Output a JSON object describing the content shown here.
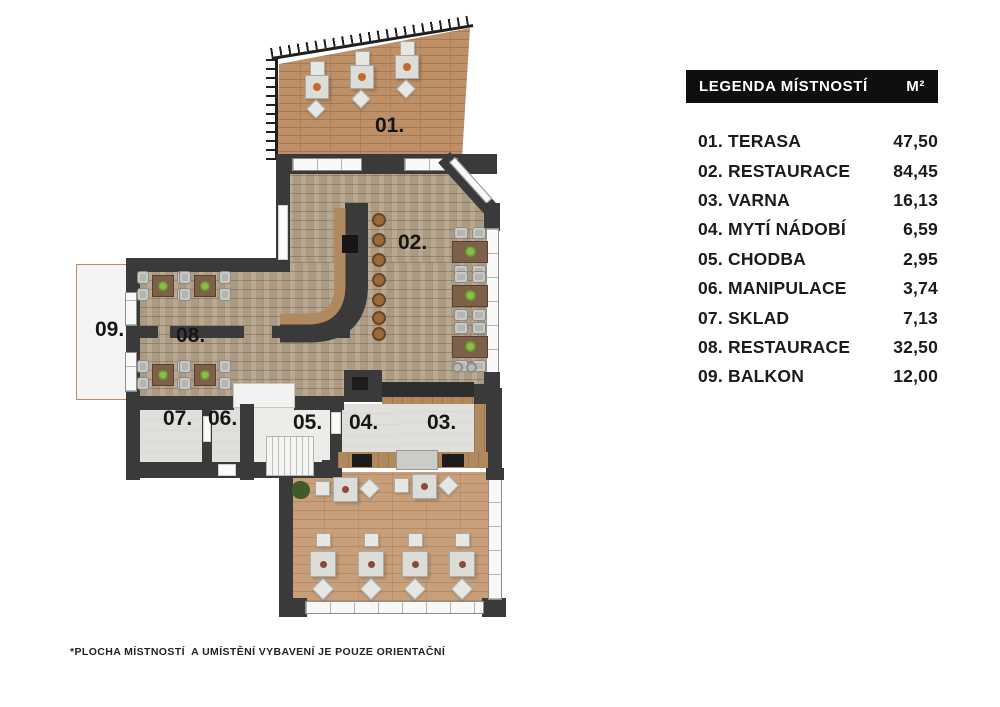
{
  "legend": {
    "title": "LEGENDA MÍSTNOSTÍ",
    "unit": "M²",
    "rows": [
      {
        "name": "01. TERASA",
        "area": "47,50"
      },
      {
        "name": "02. RESTAURACE",
        "area": "84,45"
      },
      {
        "name": "03. VARNA",
        "area": "16,13"
      },
      {
        "name": "04. MYTÍ NÁDOBÍ",
        "area": "6,59"
      },
      {
        "name": "05. CHODBA",
        "area": "2,95"
      },
      {
        "name": "06. MANIPULACE",
        "area": "3,74"
      },
      {
        "name": "07. SKLAD",
        "area": "7,13"
      },
      {
        "name": "08. RESTAURACE",
        "area": "32,50"
      },
      {
        "name": "09. BALKON",
        "area": "12,00"
      }
    ]
  },
  "plan": {
    "labels": {
      "r1": "01.",
      "r2": "02.",
      "r3": "03.",
      "r4": "04.",
      "r5": "05.",
      "r6": "06.",
      "r7": "07.",
      "r8": "08.",
      "r9": "09."
    }
  },
  "footnote": "*PLOCHA MÍSTNOSTÍ  A UMÍSTĚNÍ VYBAVENÍ JE POUZE ORIENTAČNÍ",
  "colors": {
    "wall": "#3a3a3a",
    "brick_floor": "#b5a48c",
    "wood_floor": "#bd9068",
    "dining_wood_floor": "#c89f79",
    "service_floor": "#e0dfdb",
    "legend_header_bg": "#0f0f0f",
    "legend_header_text": "#ffffff",
    "table_brown": "#7e6049",
    "plant_green": "#5c8a2e"
  }
}
